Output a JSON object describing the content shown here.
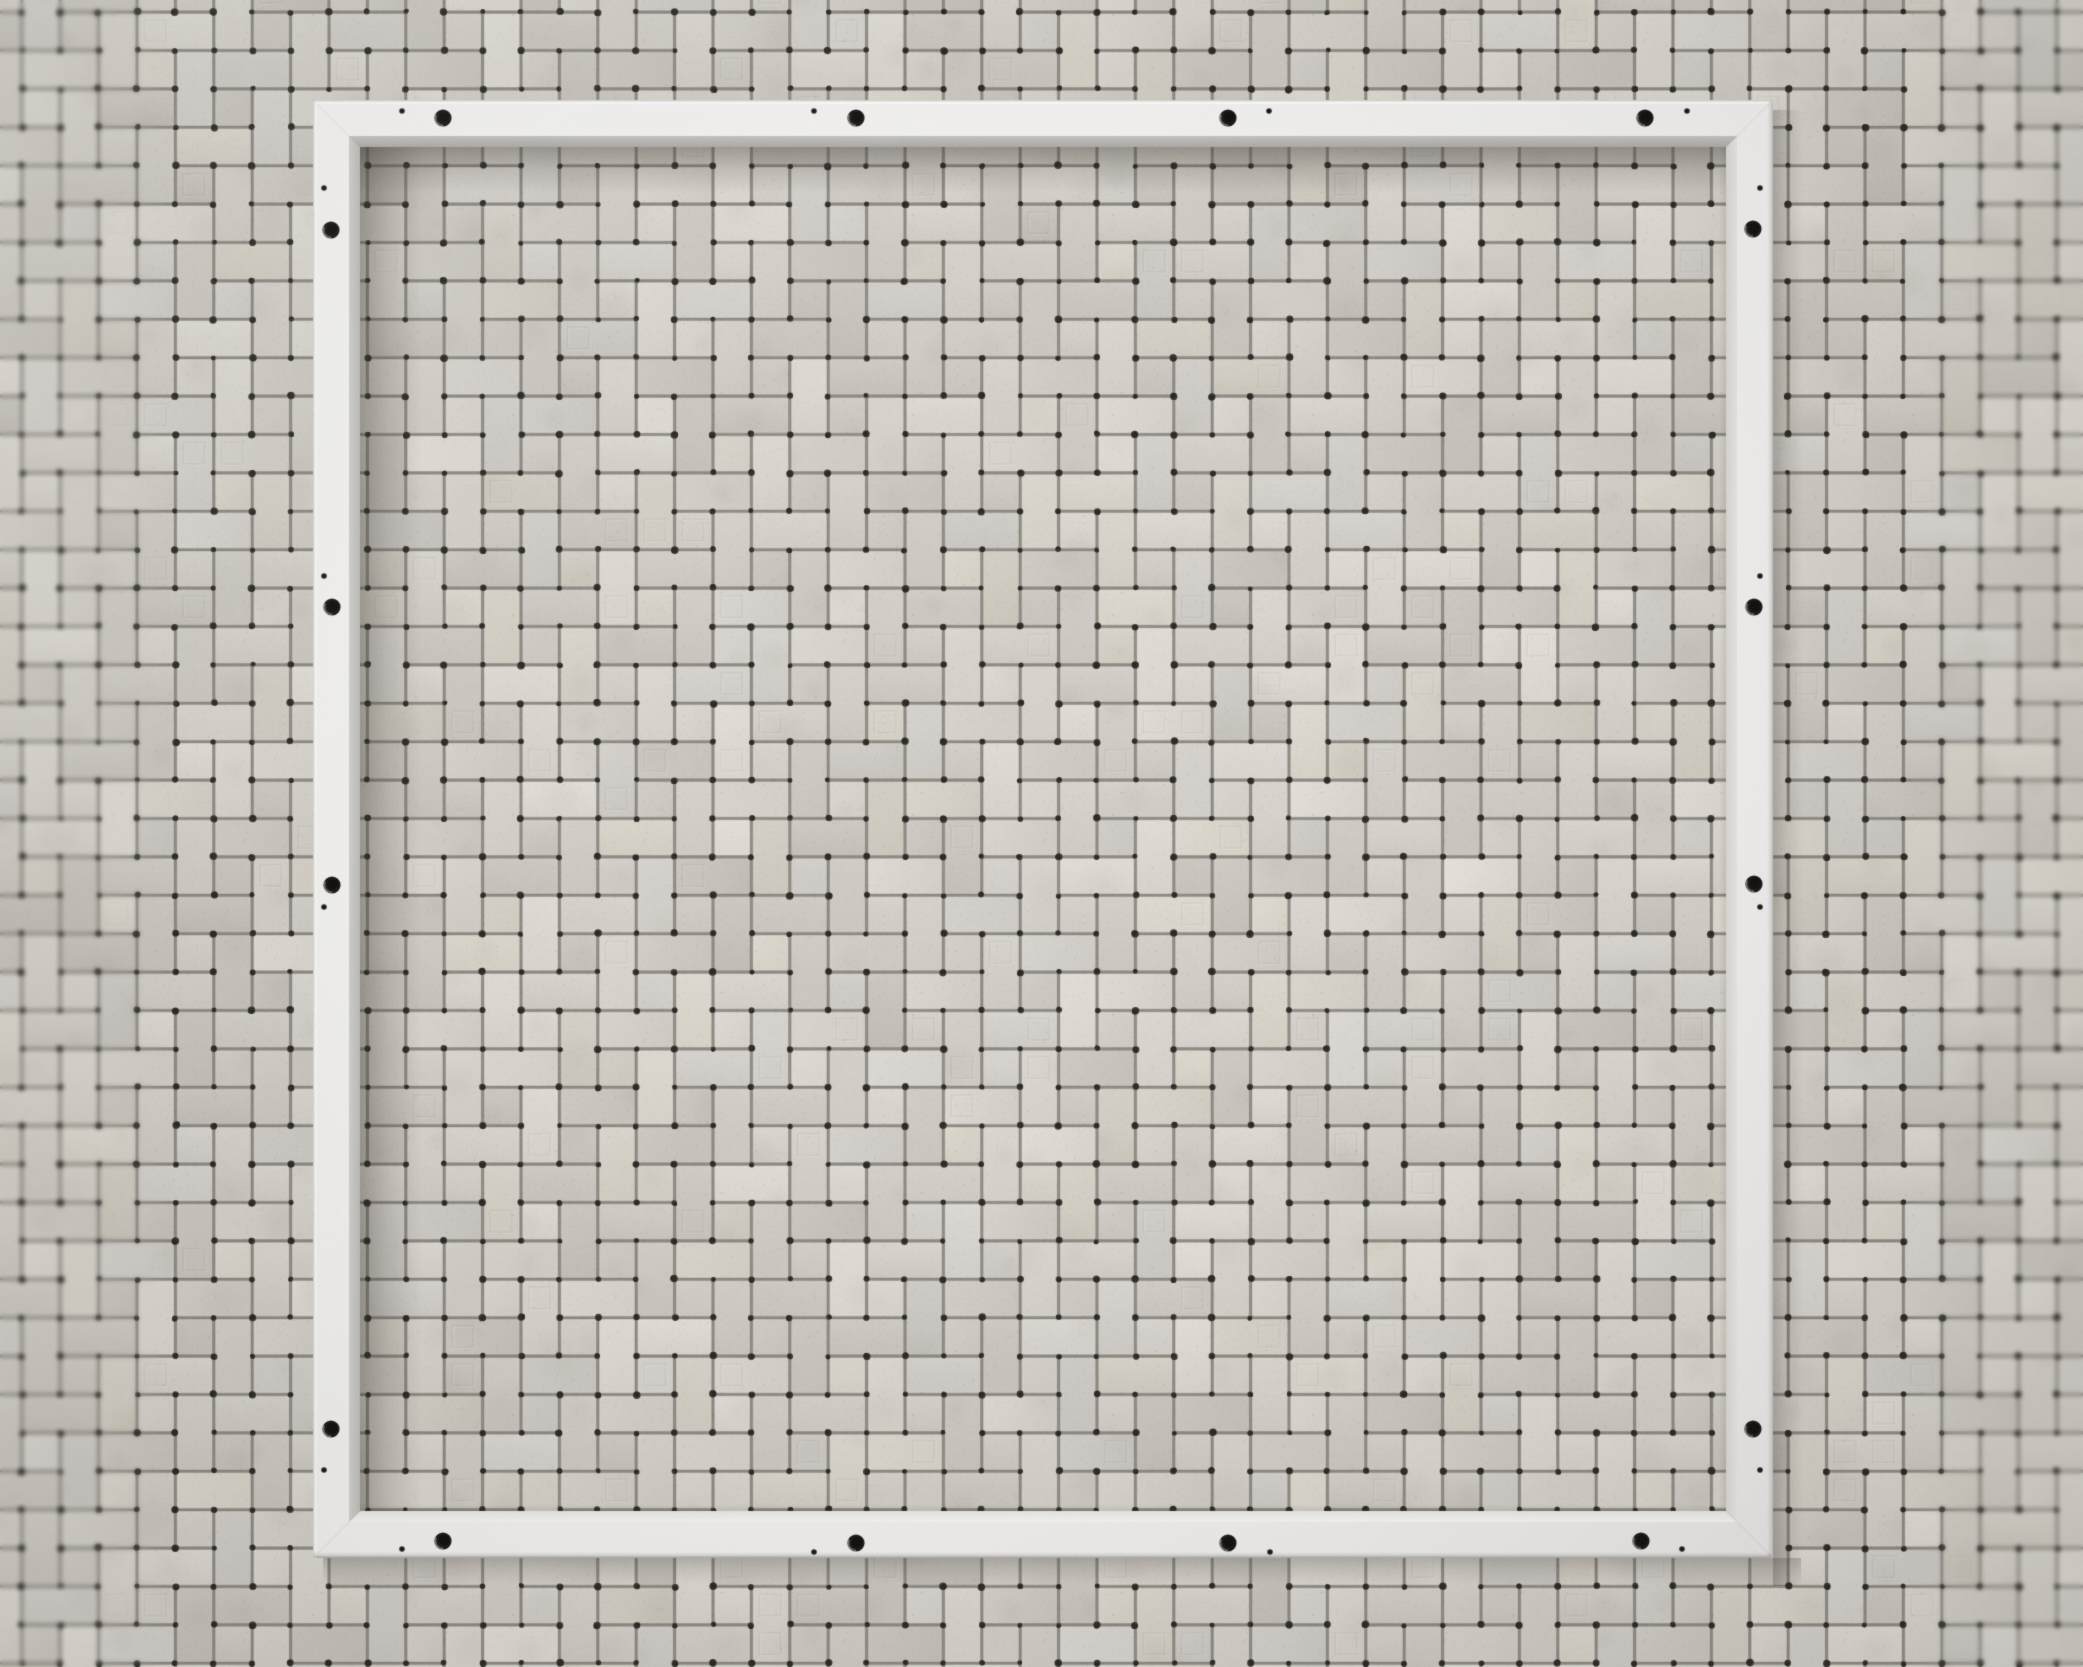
{
  "meta": {
    "alt": "White square metal mounting frame with screw holes fixed on a grey pinwheel mosaic tile wall"
  },
  "scene": {
    "canvas": {
      "width": 2083,
      "height": 1667,
      "background": "#c9c6c0"
    },
    "wall": {
      "pattern": "pinwheel-mosaic",
      "cell_size": 38.4,
      "offset_x": 21.8,
      "offset_y": 12.1,
      "grout_gap": 2.6,
      "grout_color": "#918e87",
      "grout_dot_color": "#2b2925",
      "tile_palette": [
        "#d6d2cb",
        "#d2cec7",
        "#dad6cf",
        "#cecac3",
        "#d8d3c9",
        "#d4d1cc",
        "#d0ccc5",
        "#dcd8d1"
      ],
      "tile_corner_radius": 1.8,
      "tile_edge_alpha": 0.18,
      "emboss_rate": 0.085,
      "stain_rate": 0.33,
      "noise_alpha_wall": 0.5,
      "noise_alpha_global": 0.14
    },
    "frame": {
      "outer_x": 313,
      "outer_y": 100,
      "outer_w": 1460,
      "outer_h": 1458,
      "face_width": 36,
      "bevel_width": 11,
      "corner_radius": 5,
      "face_color": "#f1f0ee",
      "face_light": "rgba(255,255,255,0.30)",
      "face_dark": "rgba(40,38,34,0.05)",
      "edge_top": "#d7d6d3",
      "edge_left": "#dbdad7",
      "edge_bottom": "#b4b2af",
      "edge_right": "#c8c7c4",
      "bevel_top": [
        "#c6c4c0",
        "#aeaca8"
      ],
      "bevel_left": [
        "#d2d0cc",
        "#bfbdb9"
      ],
      "bevel_right": [
        "#e7e6e3",
        "#d8d7d4"
      ],
      "bevel_bottom": [
        "#f6f5f3",
        "#e8e7e4"
      ],
      "miter_alpha": 0.05
    },
    "holes": {
      "color": "#1d1b18",
      "core_color": "#14120f",
      "highlight": "rgba(205,202,195,0.55)",
      "large_radius": 8.6,
      "small_radius": 2.8,
      "large": [
        [
          443,
          118
        ],
        [
          856,
          118
        ],
        [
          1228,
          118
        ],
        [
          1645,
          118
        ],
        [
          443,
          1541
        ],
        [
          856,
          1543
        ],
        [
          1228,
          1543
        ],
        [
          1641,
          1541
        ],
        [
          331,
          230
        ],
        [
          332,
          607
        ],
        [
          332,
          885
        ],
        [
          331,
          1429
        ],
        [
          1753,
          229
        ],
        [
          1754,
          607
        ],
        [
          1754,
          884
        ],
        [
          1753,
          1429
        ]
      ],
      "small": [
        [
          402,
          111
        ],
        [
          814,
          111
        ],
        [
          1269,
          111
        ],
        [
          1687,
          111
        ],
        [
          402,
          1549
        ],
        [
          814,
          1552
        ],
        [
          1270,
          1552
        ],
        [
          1682,
          1549
        ],
        [
          324,
          188
        ],
        [
          324,
          576
        ],
        [
          324,
          907
        ],
        [
          324,
          1470
        ],
        [
          1760,
          188
        ],
        [
          1760,
          576
        ],
        [
          1760,
          907
        ],
        [
          1760,
          1470
        ]
      ]
    },
    "shadows": {
      "color": "54,49,42",
      "inner_top": {
        "size": 46,
        "alpha": 0.38
      },
      "inner_left": {
        "size": 62,
        "alpha": 0.36
      },
      "outer_right": {
        "size": 30,
        "alpha": 0.27
      },
      "outer_bottom": {
        "size": 26,
        "alpha": 0.24
      },
      "ao_alpha": 0.1
    },
    "vignette": {
      "alpha": 0.1,
      "light_alpha": 0.055
    },
    "defocus": {
      "left_width": 170,
      "right_width": 180,
      "blur_px": 2.2
    }
  }
}
